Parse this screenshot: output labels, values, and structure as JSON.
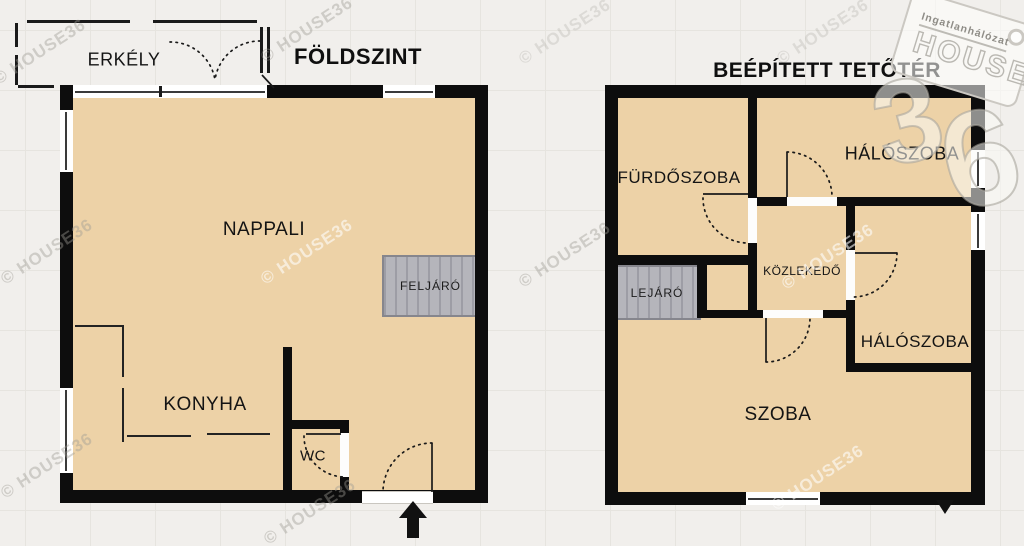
{
  "watermark": {
    "text": "© HOUSE36"
  },
  "logo": {
    "network": "Ingatlanhálózat",
    "brand": "HOUSE",
    "number_3": "3",
    "number_6": "6"
  },
  "ground_floor": {
    "title": "FÖLDSZINT",
    "rooms": {
      "balcony": "ERKÉLY",
      "living_room": "NAPPALI",
      "kitchen": "KONYHA",
      "wc": "WC",
      "stairs_up": "FELJÁRÓ"
    }
  },
  "attic": {
    "title": "BEÉPÍTETT TETŐTÉR",
    "rooms": {
      "bathroom": "FÜRDŐSZOBA",
      "bedroom_1": "HÁLÓSZOBA",
      "hallway": "KÖZLEKEDŐ",
      "stairs_down": "LEJÁRÓ",
      "bedroom_2": "HÁLÓSZOBA",
      "room": "SZOBA"
    }
  },
  "colors": {
    "floor": "#edd2a7",
    "wall": "#0d0d0d",
    "background": "#f1efec",
    "stairs_fill": "#b5b5bb",
    "stairs_border": "#86868d"
  }
}
